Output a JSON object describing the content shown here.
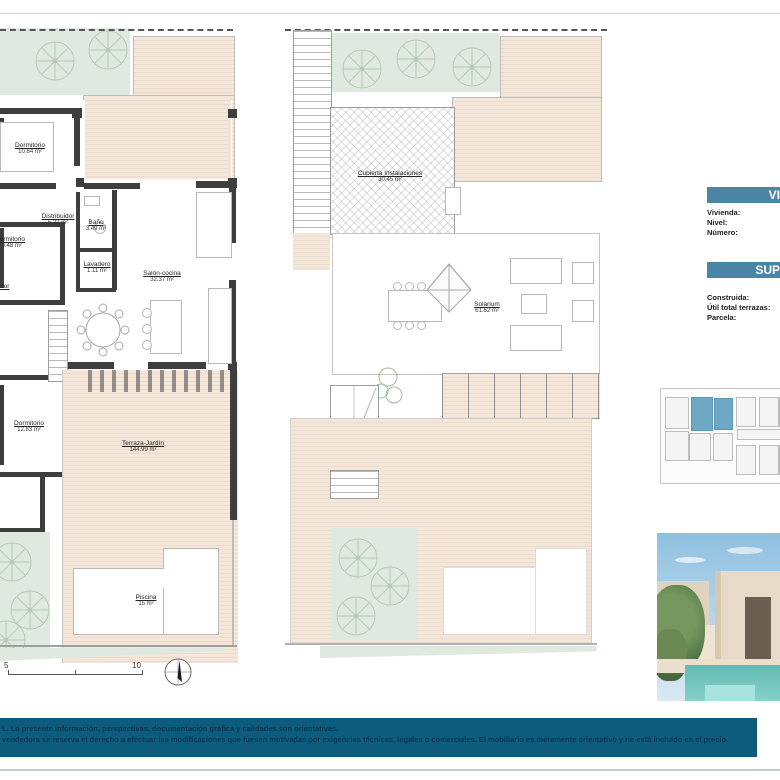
{
  "document": {
    "type": "real-estate floor plan sheet"
  },
  "colors": {
    "header_bar": "#4a86a4",
    "disclaimer_bar": "#0d5c7d",
    "disclaimer_text": "#0a3850",
    "site_plan_highlight": "#6fa8c4",
    "deck_beige": "#f4e7d9",
    "garden_green": "#dfe9df",
    "wall_dark": "#3e3e3e",
    "pool_turquoise": "#63b9b1"
  },
  "plans": {
    "left": {
      "rooms": [
        {
          "name": "Dormitorio",
          "area": "10.64 m²"
        },
        {
          "name": "Distribuidor",
          "area": "5.22 m²"
        },
        {
          "name": "Baño",
          "area": "3.49 m²"
        },
        {
          "name": "Dormitorio",
          "area": "10.48 m²"
        },
        {
          "name": "Lavadero",
          "area": "1.11 m²"
        },
        {
          "name": "Salón-cocina",
          "area": "32.37 m²"
        },
        {
          "name": "Dormitorio",
          "area": "12.83 m²"
        },
        {
          "name": "Terraza-Jardín",
          "area": "144.99 m²"
        },
        {
          "name": "Piscina",
          "area": "15 m²"
        }
      ],
      "cut_label": "dor"
    },
    "right": {
      "rooms": [
        {
          "name": "Cubierta Instalaciones",
          "area": "30.45 m²"
        },
        {
          "name": "Solarium",
          "area": "61.62 m²"
        }
      ]
    }
  },
  "scale": {
    "mid": "5",
    "end": "10"
  },
  "info": {
    "header1": "VI",
    "header2": "SUP",
    "fields1": [
      {
        "label": "Vivienda:"
      },
      {
        "label": "Nivel:"
      },
      {
        "label": "Número:"
      }
    ],
    "fields2": [
      {
        "label": "Construida:"
      },
      {
        "label": "Útil total terrazas:"
      },
      {
        "label": "Parcela:"
      }
    ]
  },
  "disclaimer": {
    "line1": "L. La presente información, perspectivas, documentación gráfica y calidades son orientativas.",
    "line2": "vendedora se reserva el derecho a efectuar las modificaciones que fuesen motivadas por exigencias técnicas, legales o comerciales. El mobiliario es meramente orientativo y no está incluido en el precio."
  }
}
